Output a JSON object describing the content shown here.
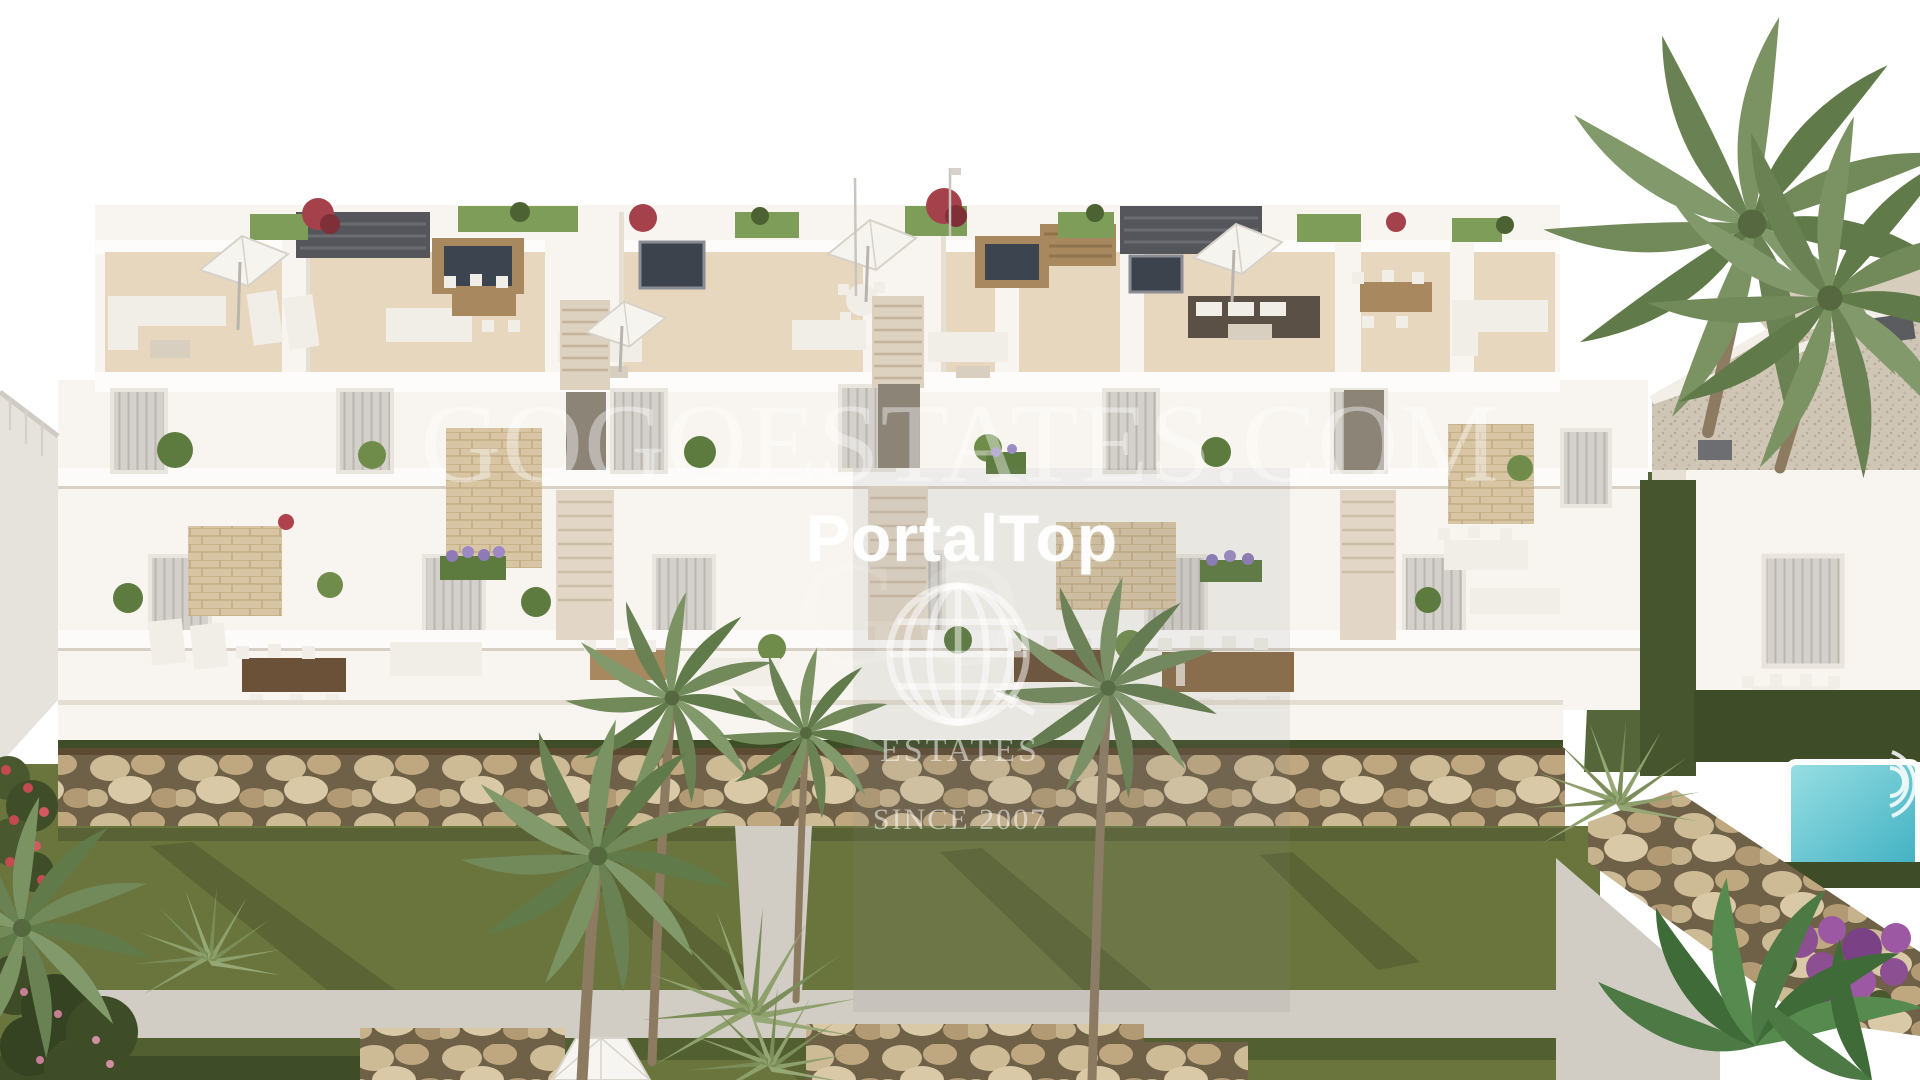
{
  "image": {
    "kind": "real-estate architectural rendering",
    "description": "Aerial view of a modern white multi-unit residential complex with rooftop terraces, balconies, rock retaining wall, lawn with palm trees, and a neighbouring villa with a small pool"
  },
  "watermarks": {
    "site_text": "GOGOESTATES.COM",
    "portal_text": "PortalTop",
    "monogram_text": "GO",
    "logo": {
      "icon": "globe-wireframe-icon",
      "estates_label": "ESTATES",
      "since_label": "SINCE 2007"
    }
  },
  "palette": {
    "sky": "#ffffff",
    "building_white": "#f8f5f0",
    "deck_tan": "#e8d7bf",
    "roof_grass": "#7d9d59",
    "lawn_green": "#6a753e",
    "hedge_green": "#3f4c28",
    "rock_beige": "#cdbb96",
    "stone_clad": "#d8c5a4",
    "pergola_dark": "#54565b",
    "wood_brown": "#a8885f",
    "pool_teal": "#52bcc9",
    "bougainvillea_purple": "#8c4f92",
    "watermark_white": "#ffffff"
  }
}
